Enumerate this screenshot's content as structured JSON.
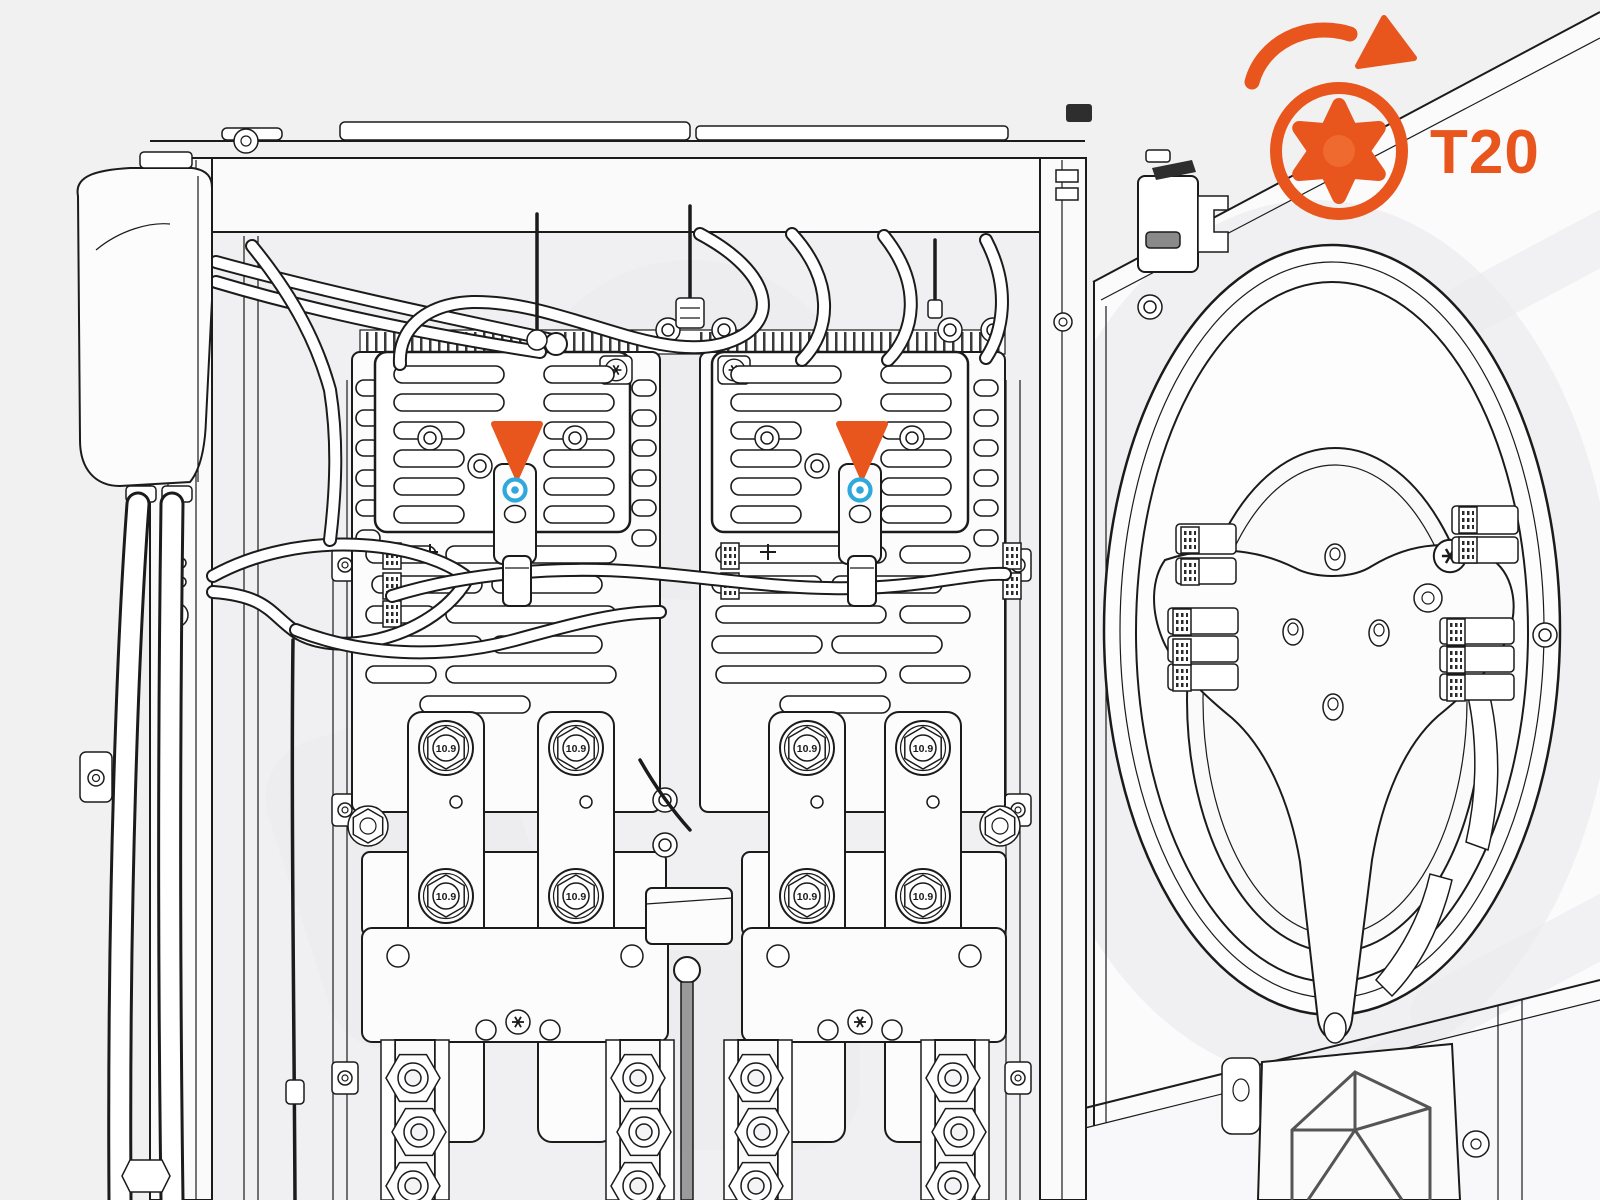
{
  "palette": {
    "accent_orange": "#E8551D",
    "accent_orange_light": "#EF6A2E",
    "highlight_cyan": "#2FA8DB",
    "canvas_bg": "#F1F1F2",
    "line": "#1B1B1B"
  },
  "callout": {
    "label": "T20",
    "tool": "torx-screwdriver-bit",
    "action": "rotate-clockwise"
  },
  "markers": [
    {
      "position": "left-vent-cover",
      "shape": "triangle-down",
      "target": "cover-screw",
      "highlight": "cyan-ring"
    },
    {
      "position": "right-vent-cover",
      "shape": "triangle-down",
      "target": "cover-screw",
      "highlight": "cyan-ring"
    }
  ],
  "bolts": [
    {
      "label": "10.9"
    },
    {
      "label": "10.9"
    },
    {
      "label": "10.9"
    },
    {
      "label": "10.9"
    },
    {
      "label": "10.9"
    },
    {
      "label": "10.9"
    },
    {
      "label": "10.9"
    },
    {
      "label": "10.9"
    }
  ]
}
